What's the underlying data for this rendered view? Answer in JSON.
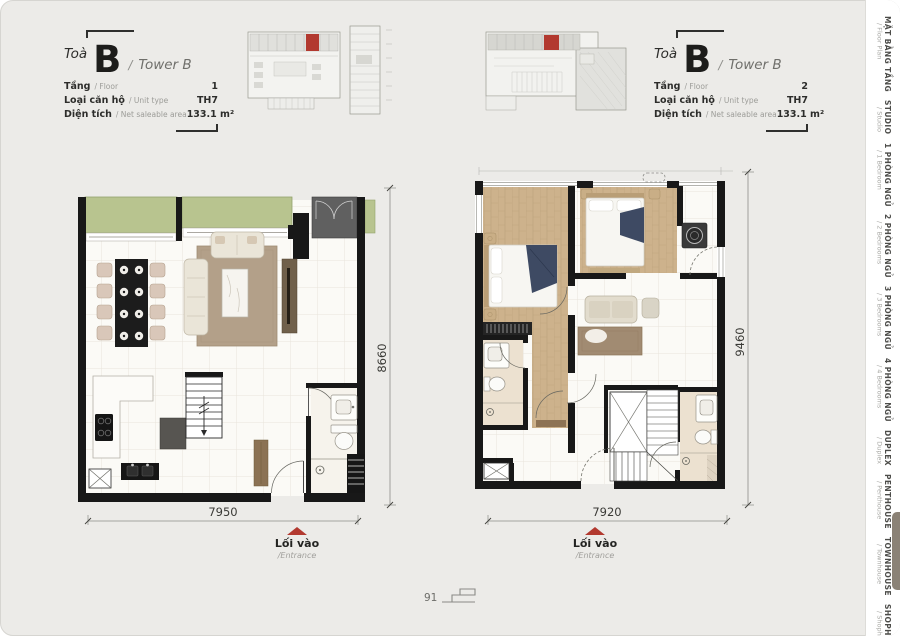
{
  "page": {
    "background": "#ecebe8",
    "number": "91"
  },
  "headers": [
    {
      "prefix": "Toà",
      "tower": "B",
      "divider": "/",
      "tower_en": "Tower B",
      "rows": [
        {
          "label": "Tầng",
          "sub": "/ Floor",
          "value": "1"
        },
        {
          "label": "Loại căn hộ",
          "sub": "/ Unit type",
          "value": "TH7"
        },
        {
          "label": "Diện tích",
          "sub": "/ Net saleable area",
          "value": "133.1 m²"
        }
      ]
    },
    {
      "prefix": "Toà",
      "tower": "B",
      "divider": "/",
      "tower_en": "Tower B",
      "rows": [
        {
          "label": "Tầng",
          "sub": "/ Floor",
          "value": "2"
        },
        {
          "label": "Loại căn hộ",
          "sub": "/ Unit type",
          "value": "TH7"
        },
        {
          "label": "Diện tích",
          "sub": "/ Net saleable area",
          "value": "133.1 m²"
        }
      ]
    }
  ],
  "plans": [
    {
      "width_dim": "7950",
      "height_dim": "8660",
      "entrance_label": "Lối vào",
      "entrance_sub": "/Entrance"
    },
    {
      "width_dim": "7920",
      "height_dim": "9460",
      "entrance_label": "Lối vào",
      "entrance_sub": "/Entrance"
    }
  ],
  "sidebar": {
    "active_item": "TOWNHOUSE",
    "items": [
      {
        "label": "MẶT BẰNG TẦNG",
        "sub": "/ Floor Plan"
      },
      {
        "label": "STUDIO",
        "sub": "/ Studio"
      },
      {
        "label": "1 PHÒNG NGỦ",
        "sub": "/ 1 Bedroom"
      },
      {
        "label": "2 PHÒNG NGỦ",
        "sub": "/ 2 Bedrooms"
      },
      {
        "label": "3 PHÒNG NGỦ",
        "sub": "/ 3 Bedrooms"
      },
      {
        "label": "4 PHÒNG NGỦ",
        "sub": "/ 4 Bedrooms"
      },
      {
        "label": "DUPLEX",
        "sub": "/ Duplex"
      },
      {
        "label": "PENTHOUSE",
        "sub": "/ Penthouse"
      },
      {
        "label": "TOWNHOUSE",
        "sub": "/ Townhouse"
      },
      {
        "label": "SHOPHOUSE",
        "sub": "/ Shophouse"
      }
    ]
  },
  "colors": {
    "accent_red": "#b2392f",
    "active_tab": "#8b8276"
  }
}
